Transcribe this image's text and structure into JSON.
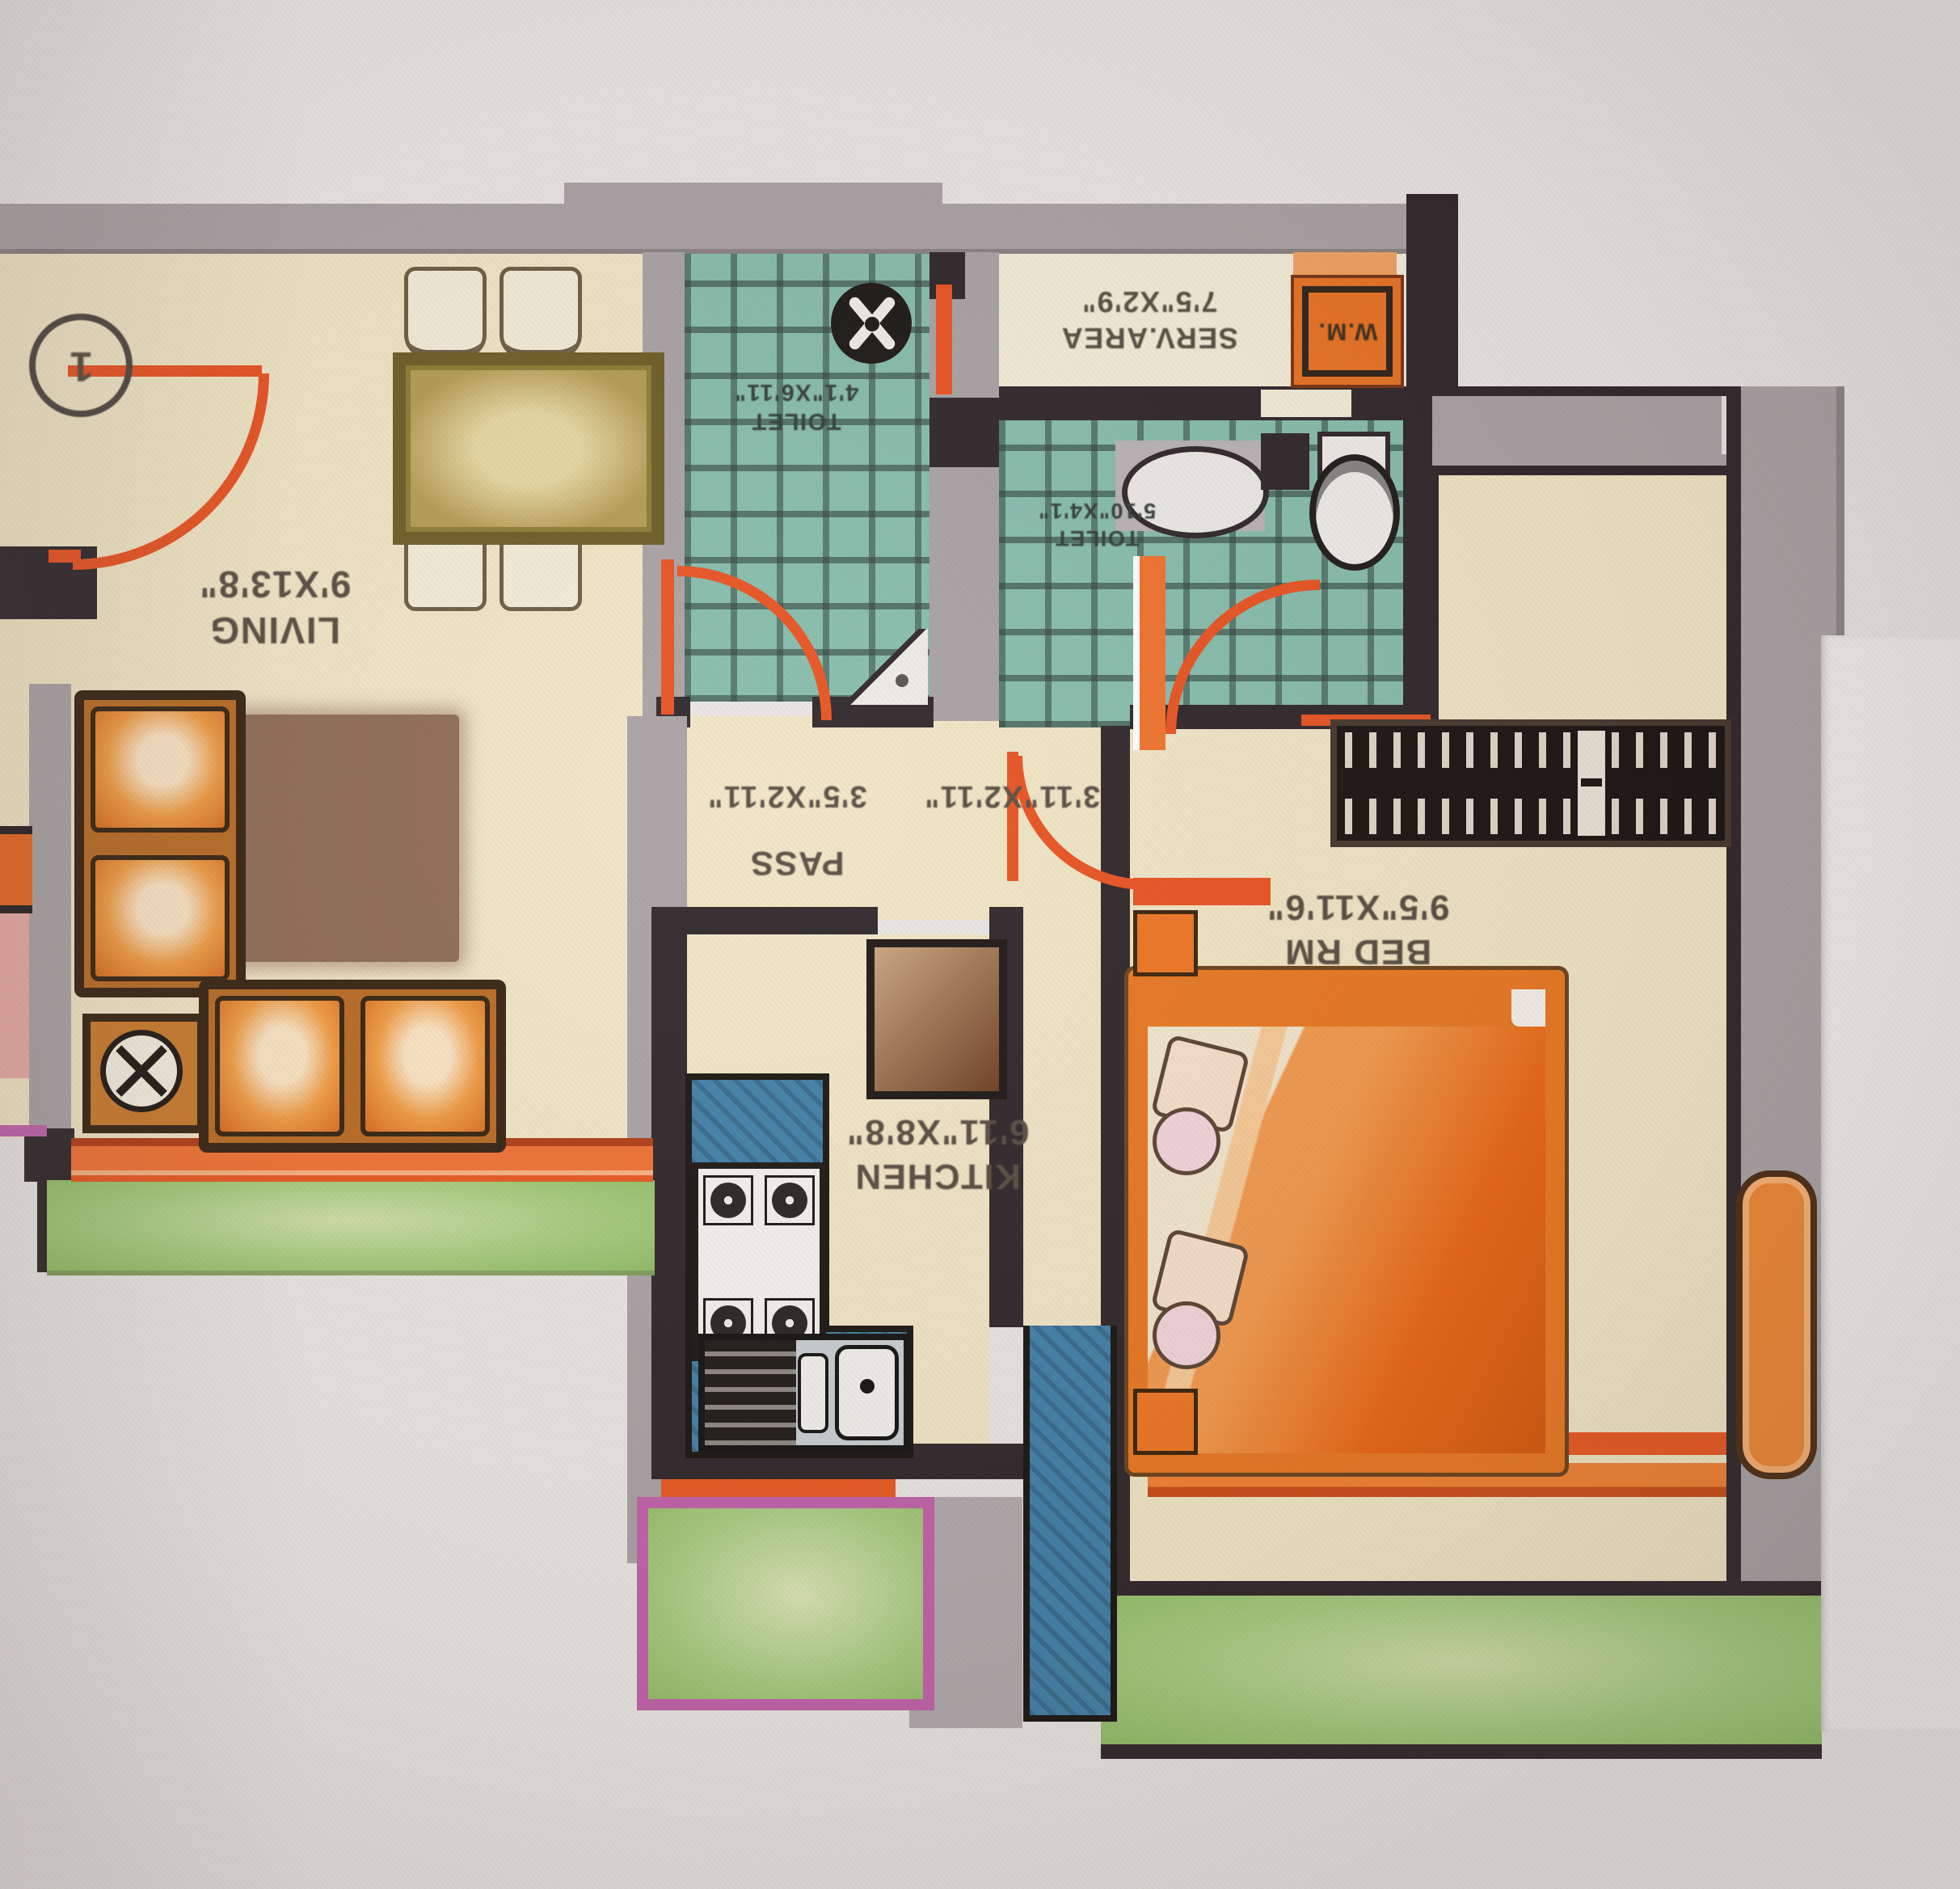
{
  "photo": {
    "paper_color": "#e9e6e3",
    "page_edge_color": "#f0efed",
    "orientation_note": "floor plan photographed upside-down; all plan text appears rotated 180 degrees"
  },
  "plan": {
    "flat_number": "1",
    "rooms": {
      "living": {
        "name": "LIVING",
        "size": "9'X13'8\""
      },
      "pass": {
        "name": "PASS",
        "size_a": "3'11\"X2'11\"",
        "size_b": "3'5\"X2'11\""
      },
      "kitchen": {
        "name": "KITCHEN",
        "size": "6'11\"X8'8\""
      },
      "bedroom": {
        "name": "BED RM",
        "size": "9'5\"X11'6\""
      },
      "service_area": {
        "name": "SERV.AREA",
        "size": "7'5\"X2'9\""
      },
      "toilet_1": {
        "name": "TOILET",
        "size": "4'1\"X6'11\""
      },
      "toilet_2": {
        "name": "TOILET",
        "size": "5'10\"X4'1\""
      },
      "washing_machine": {
        "name": "W.M."
      }
    },
    "colors": {
      "wall_grey": "#a8a1a3",
      "wall_dark": "#2b2326",
      "floor_cream": "#f1e5c4",
      "tile_teal": "#85bcab",
      "door_red": "#e8501e",
      "accent_orange": "#ee7420",
      "counter_blue": "#3f7ea6",
      "garden_green": "#a6cc7d",
      "planter_magenta": "#c060a8",
      "rug_brown": "#8d6953",
      "table_olive": "#b49a50"
    }
  }
}
